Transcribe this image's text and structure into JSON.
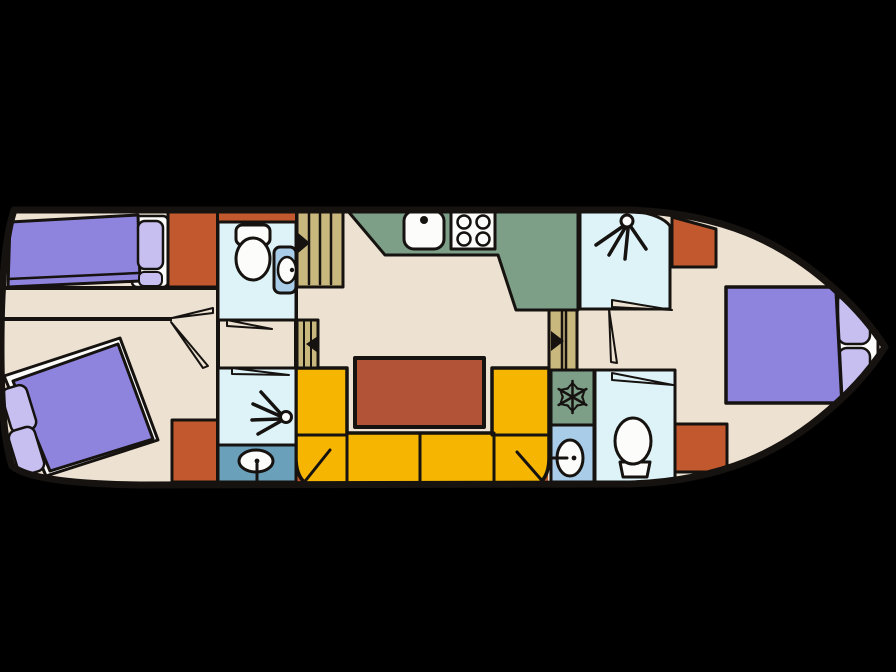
{
  "page": {
    "background": "#000000"
  },
  "figure": {
    "kind": "boat-floor-plan",
    "rooms": [
      "aft-cabin",
      "aft-wc",
      "aft-shower-room",
      "companionway",
      "galley",
      "saloon",
      "bow-shower-room",
      "bow-wc",
      "bow-cabin"
    ],
    "furniture": [
      "single-bed",
      "double-bed-aft",
      "double-bed-bow",
      "wardrobes",
      "toilets",
      "washbasins",
      "kitchen-sink",
      "stove-4-burner",
      "fridge-freezer",
      "u-shaped-bench",
      "dining-table",
      "steps"
    ],
    "icons": [
      "shower-spray-icon",
      "snowflake-icon",
      "burner-icon",
      "faucet-dot-icon",
      "step-direction-arrow-icon",
      "door-swing"
    ]
  },
  "palette": {
    "background": "#000000",
    "floor": "#ede1d2",
    "outline": "#15120f",
    "bed_purple": "#8e84de",
    "pillow_lavender": "#c6bff0",
    "cabinet_orange": "#c2592e",
    "counter_green": "#7d9f88",
    "bench_yellow": "#f6b500",
    "table_brick": "#b25338",
    "wetroom_cyan": "#def3f8",
    "basin_panel_blue": "#a9cde8",
    "basin_panel_teal": "#6ba0bb",
    "stairs_tan": "#c9b87e",
    "fixture_white": "#fcfcfa",
    "arrow_black": "#15120f"
  }
}
